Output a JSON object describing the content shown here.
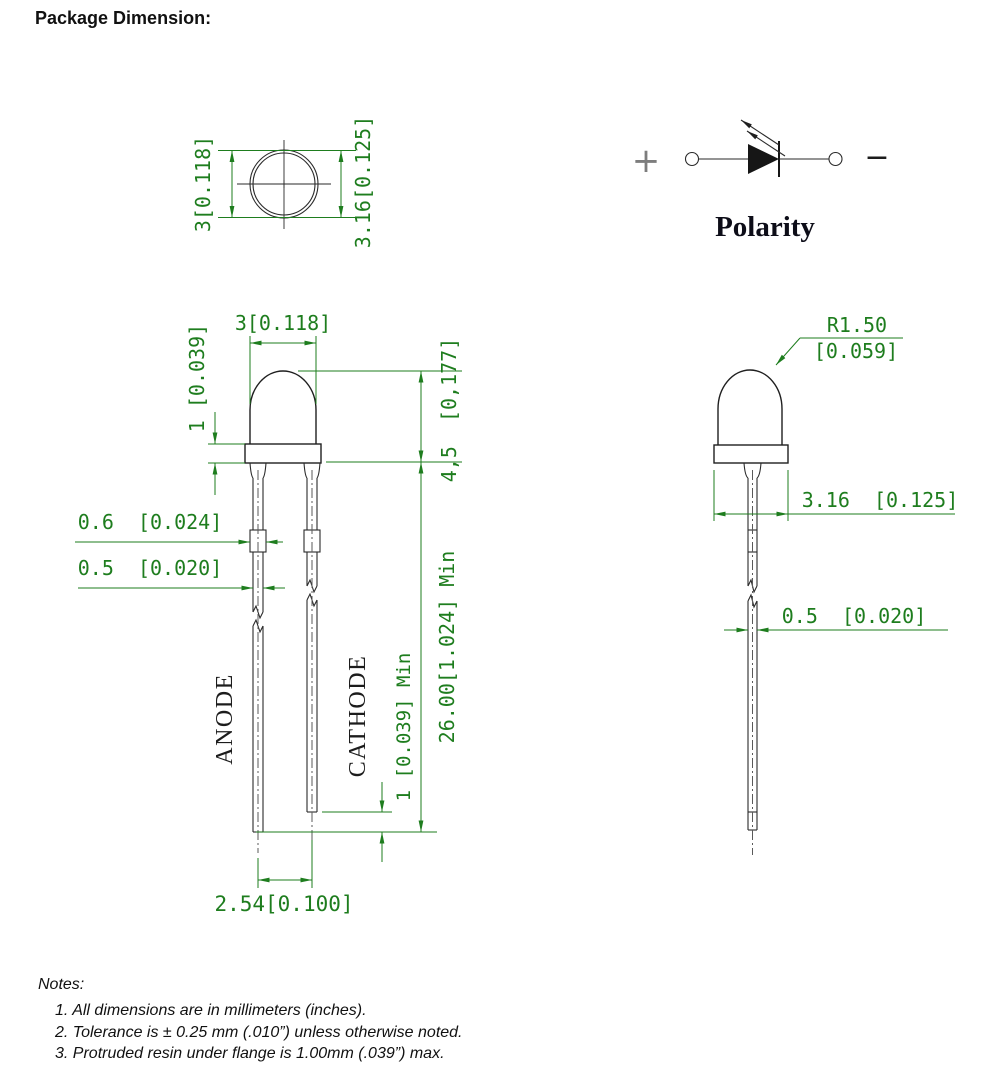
{
  "page": {
    "title": "Package Dimension:"
  },
  "colors": {
    "dimension_green": "#1e7d1e",
    "line_black": "#1f1f1f",
    "polarity_text": "#0d0d18"
  },
  "top_view": {
    "diameter_label": "3[0.118]",
    "flange_diameter_label": "3.16[0.125]"
  },
  "polarity": {
    "plus_sign": "+",
    "minus_sign": "−",
    "caption": "Polarity"
  },
  "front_view": {
    "body_width_label": "3[0.118]",
    "flange_height_label": "1 [0.039]",
    "body_height_label": "4,5  [0,177]",
    "lead_thickness_label": "0.6  [0.024]",
    "lead_width_label": "0.5  [0.020]",
    "anode_label": "ANODE",
    "cathode_label": "CATHODE",
    "lead_length_diff_label": "1 [0.039] Min",
    "lead_length_label": "26.00[1.024] Min",
    "lead_pitch_label": "2.54[0.100]"
  },
  "side_view": {
    "dome_radius_label": "R1.50",
    "dome_radius_inch_label": "[0.059]",
    "flange_width_label": "3.16  [0.125]",
    "lead_width_label": "0.5  [0.020]"
  },
  "notes": {
    "heading": "Notes:",
    "items": [
      "1. All dimensions are in millimeters (inches).",
      "2. Tolerance is ± 0.25 mm (.010”) unless otherwise noted.",
      "3. Protruded resin under flange is 1.00mm (.039”) max."
    ]
  }
}
